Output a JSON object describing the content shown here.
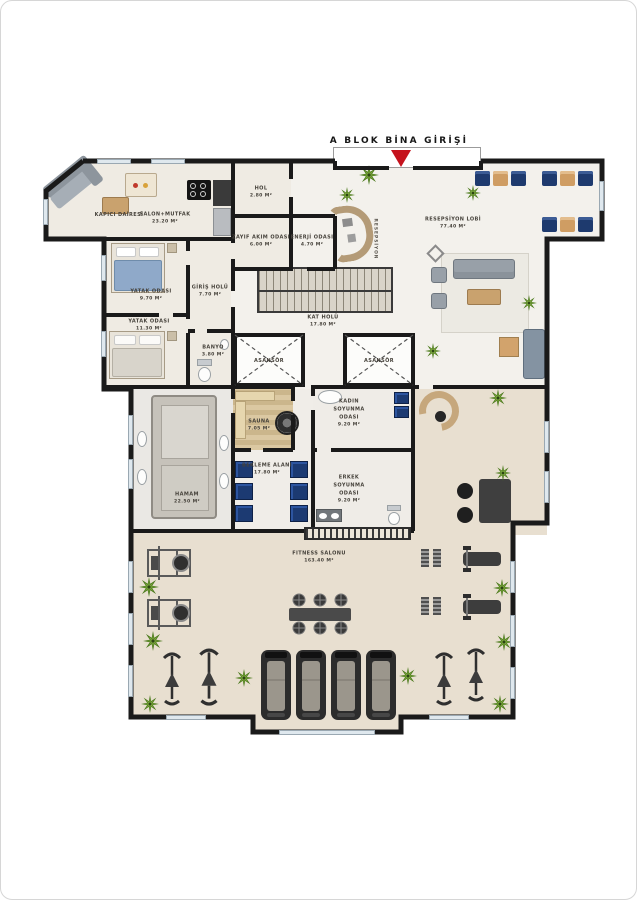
{
  "header": {
    "entrance_label": "A BLOK BİNA GİRİŞİ"
  },
  "colors": {
    "entrance_marker_red": "#c5121c",
    "wall_black": "#1a1a1a",
    "locker_blue": "#1c3a72",
    "chair_tan": "#cf9d63",
    "fitness_floor_beige": "#e8dfd0",
    "sauna_wood": "#d9c49c"
  },
  "rooms": {
    "kapici": {
      "name": "KAPICI DAİRESİ"
    },
    "salon": {
      "name": "SALON+MUTFAK",
      "area": "23.20 M²"
    },
    "hol": {
      "name": "HOL",
      "area": "2.80 M²"
    },
    "zayif": {
      "name": "ZAYIF AKIM ODASI",
      "area": "6.00 M²"
    },
    "enerji": {
      "name": "ENERJİ ODASI",
      "area": "4.70 M²"
    },
    "lobi": {
      "name": "RESEPSİYON LOBİ",
      "area": "77.40 M²"
    },
    "resepsiyon": {
      "name": "RESEPSİYON"
    },
    "yatak1": {
      "name": "YATAK ODASI",
      "area": "9.70 M²"
    },
    "giris": {
      "name": "GİRİŞ HOLÜ",
      "area": "7.70 M²"
    },
    "yatak2": {
      "name": "YATAK ODASI",
      "area": "11.30 M²"
    },
    "banyo": {
      "name": "BANYO",
      "area": "3.80 M²"
    },
    "kat": {
      "name": "KAT HOLÜ",
      "area": "17.80 M²"
    },
    "asansor1": {
      "name": "ASANSÖR"
    },
    "asansor2": {
      "name": "ASANSÖR"
    },
    "sauna": {
      "name": "SAUNA",
      "area": "7.05 M²"
    },
    "kadin": {
      "name": "KADIN SOYUNMA ODASI",
      "area": "9.20 M²"
    },
    "bekleme": {
      "name": "BEKLEME ALANI",
      "area": "17.80 M²"
    },
    "erkek": {
      "name": "ERKEK SOYUNMA ODASI",
      "area": "9.20 M²"
    },
    "hamam": {
      "name": "HAMAM",
      "area": "22.50 M²"
    },
    "fitness": {
      "name": "FITNESS SALONU",
      "area": "163.40 M²"
    }
  }
}
